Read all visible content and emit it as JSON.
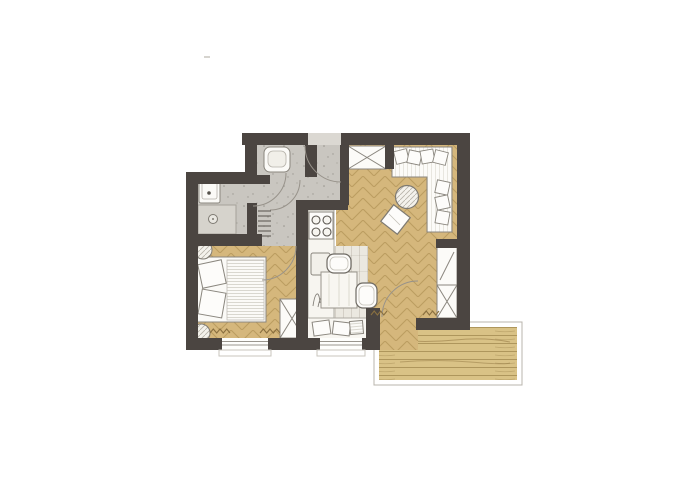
{
  "title": "apartment-floor-plan",
  "canvas": {
    "w": 700,
    "h": 500
  },
  "palette": {
    "background": "#ffffff",
    "wall": "#4b4541",
    "concrete_floor": "#c9c6c0",
    "wood_floor": "#d5b77c",
    "wood_stroke": "#927034",
    "deck_wood": "#d9c286",
    "nook_floor": "#ebe8e0",
    "furniture_fill": "#fbfaf7",
    "furniture_outline": "#8a867e",
    "door_arc": "#97928a",
    "radiator_mark": "#8a7040"
  },
  "rooms": [
    "wc-niche",
    "hallway",
    "bathroom",
    "bedroom",
    "kitchen",
    "dining-nook",
    "living-room",
    "balcony"
  ],
  "layers": [
    {
      "name": "balcony-frame",
      "kind": "rect",
      "x": 374,
      "y": 322,
      "w": 148,
      "h": 63,
      "fill": "#ffffff",
      "stroke": "#b8b4ac",
      "sw": 1
    },
    {
      "name": "balcony-deck",
      "kind": "rect",
      "x": 379,
      "y": 327,
      "w": 138,
      "h": 53,
      "fill": "url(#pat-planks)"
    },
    {
      "name": "balcony-grain-1",
      "kind": "path",
      "d": "M395,340 q30,3 60,0 t55,2",
      "stroke": "rgba(130,103,50,0.45)",
      "sw": 1
    },
    {
      "name": "balcony-grain-2",
      "kind": "path",
      "d": "M400,362 q35,-3 70,0 t40,1",
      "stroke": "rgba(130,103,50,0.4)",
      "sw": 1
    },
    {
      "name": "floor-living",
      "kind": "rect",
      "x": 336,
      "y": 145,
      "w": 121,
      "h": 173,
      "fill": "url(#pat-herr)"
    },
    {
      "name": "floor-balcony-door",
      "kind": "rect",
      "x": 378,
      "y": 300,
      "w": 40,
      "h": 50,
      "fill": "url(#pat-herr)"
    },
    {
      "name": "floor-dining-nook",
      "kind": "rect",
      "x": 308,
      "y": 246,
      "w": 60,
      "h": 92,
      "fill": "url(#pat-nook)"
    },
    {
      "name": "floor-bedroom",
      "kind": "rect",
      "x": 198,
      "y": 245,
      "w": 98,
      "h": 93,
      "fill": "url(#pat-herr)"
    },
    {
      "name": "floor-hallway",
      "kind": "rect",
      "x": 257,
      "y": 145,
      "w": 84,
      "h": 65,
      "fill": "url(#pat-speckle)"
    },
    {
      "name": "floor-hallway-2",
      "kind": "rect",
      "x": 257,
      "y": 203,
      "w": 39,
      "h": 43,
      "fill": "url(#pat-speckle)"
    },
    {
      "name": "floor-bathroom",
      "kind": "rect",
      "x": 198,
      "y": 172,
      "w": 59,
      "h": 62,
      "fill": "url(#pat-speckle)"
    },
    {
      "name": "entry-threshold",
      "kind": "rect",
      "x": 308,
      "y": 133,
      "w": 33,
      "h": 12,
      "fill": "#dbd8d2"
    },
    {
      "name": "shower-tray",
      "kind": "rect",
      "x": 198,
      "y": 205,
      "w": 38,
      "h": 29,
      "fill": "#d6d3cc",
      "stroke": "#a5a19a",
      "sw": 1
    },
    {
      "name": "shower-drain",
      "kind": "circle",
      "cx": 213,
      "cy": 219,
      "r": 4.5,
      "fill": "#e9e7e1",
      "stroke": "#7e7a72",
      "sw": 1
    },
    {
      "name": "shower-drain-dot",
      "kind": "circle",
      "cx": 213,
      "cy": 219,
      "r": 1,
      "fill": "#7e7a72"
    },
    {
      "name": "washbasin",
      "kind": "rect",
      "x": 199,
      "y": 174,
      "w": 21,
      "h": 29,
      "rx": 2,
      "fill": "#fbfaf7",
      "stroke": "#8a867e",
      "sw": 1
    },
    {
      "name": "washbasin-inner",
      "kind": "rect",
      "x": 202,
      "y": 178,
      "w": 15,
      "h": 21,
      "rx": 2,
      "fill": "none",
      "stroke": "#b5b1a9",
      "sw": 0.8
    },
    {
      "name": "washbasin-tap-dot",
      "kind": "circle",
      "cx": 209,
      "cy": 193,
      "r": 1.8,
      "fill": "#56524c"
    },
    {
      "name": "toilet",
      "kind": "rect",
      "x": 264,
      "y": 147,
      "w": 26,
      "h": 25,
      "rx": 6,
      "fill": "#fbfaf7",
      "stroke": "#8a867e",
      "sw": 1
    },
    {
      "name": "toilet-bowl-inner",
      "kind": "rect",
      "x": 268,
      "y": 151,
      "w": 18,
      "h": 16,
      "rx": 5,
      "fill": "#f1efe9",
      "stroke": "#b5b1a9",
      "sw": 0.8
    },
    {
      "name": "hall-radiator",
      "kind": "ticks",
      "x": 258,
      "y": 211,
      "w": 13,
      "n": 6,
      "gap": 5,
      "stroke": "#56524c",
      "sw": 1
    },
    {
      "name": "bed-frame",
      "kind": "rect",
      "x": 196,
      "y": 257,
      "w": 70,
      "h": 65,
      "fill": "#fbfaf7",
      "stroke": "#8a867e",
      "sw": 1
    },
    {
      "name": "bed-duvet",
      "kind": "rect",
      "x": 227,
      "y": 260,
      "w": 37,
      "h": 60,
      "fill": "url(#pat-duvet)",
      "stroke": "#c2bfb7",
      "sw": 0.8
    },
    {
      "name": "bed-pillow-1",
      "kind": "rect",
      "x": 200,
      "y": 262,
      "w": 24,
      "h": 24,
      "rot": -12,
      "fill": "#fdfcfa",
      "stroke": "#8a867e",
      "sw": 1
    },
    {
      "name": "bed-pillow-2",
      "kind": "rect",
      "x": 200,
      "y": 291,
      "w": 24,
      "h": 25,
      "rot": 10,
      "fill": "#fdfcfa",
      "stroke": "#8a867e",
      "sw": 1
    },
    {
      "name": "bedroom-plant-1",
      "kind": "circle",
      "cx": 203,
      "cy": 250,
      "r": 9,
      "fill": "url(#pat-hatch)",
      "stroke": "#7e7a72",
      "sw": 1
    },
    {
      "name": "bedroom-plant-2",
      "kind": "circle",
      "cx": 201,
      "cy": 333,
      "r": 9,
      "fill": "url(#pat-hatch)",
      "stroke": "#7e7a72",
      "sw": 1
    },
    {
      "name": "bedroom-wardrobe",
      "kind": "xbox",
      "x": 280,
      "y": 299,
      "w": 24,
      "h": 39,
      "fill": "#fcfbf8",
      "stroke": "#8a867e",
      "sw": 1
    },
    {
      "name": "kitchen-counter",
      "kind": "rect",
      "x": 308,
      "y": 210,
      "w": 26,
      "h": 108,
      "fill": "#f7f5f0",
      "stroke": "#aeaaa2",
      "sw": 1
    },
    {
      "name": "stove",
      "kind": "rect",
      "x": 309,
      "y": 212,
      "w": 24,
      "h": 27,
      "fill": "#fdfcfa",
      "stroke": "#8a867e",
      "sw": 1
    },
    {
      "name": "burner-1",
      "kind": "circle",
      "cx": 316,
      "cy": 220,
      "r": 4,
      "fill": "#f7f5f0",
      "stroke": "#5b5751",
      "sw": 1.1
    },
    {
      "name": "burner-2",
      "kind": "circle",
      "cx": 327,
      "cy": 220,
      "r": 4,
      "fill": "#f7f5f0",
      "stroke": "#5b5751",
      "sw": 1.1
    },
    {
      "name": "burner-3",
      "kind": "circle",
      "cx": 316,
      "cy": 232,
      "r": 4,
      "fill": "#f7f5f0",
      "stroke": "#5b5751",
      "sw": 1.1
    },
    {
      "name": "burner-4",
      "kind": "circle",
      "cx": 327,
      "cy": 232,
      "r": 4,
      "fill": "#f7f5f0",
      "stroke": "#5b5751",
      "sw": 1.1
    },
    {
      "name": "kitchen-sink",
      "kind": "rect",
      "x": 311,
      "y": 253,
      "w": 19,
      "h": 22,
      "rx": 2,
      "fill": "#f2f0ea",
      "stroke": "#8a867e",
      "sw": 1
    },
    {
      "name": "kitchen-plant-sketch",
      "kind": "path",
      "d": "M313,306 C315,292 319,289 320,303 M318,307 C321,292 326,293 327,305 M322,306 C323,297 327,295 329,303",
      "stroke": "#85817a",
      "sw": 0.9
    },
    {
      "name": "dining-table",
      "kind": "rect",
      "x": 321,
      "y": 272,
      "w": 36,
      "h": 36,
      "fill": "#f8f6f1",
      "stroke": "#98948c",
      "sw": 1
    },
    {
      "name": "table-grain-1",
      "kind": "line",
      "x1": 329,
      "y1": 274,
      "x2": 329,
      "y2": 306,
      "stroke": "#ddd9d0",
      "sw": 1
    },
    {
      "name": "table-grain-2",
      "kind": "line",
      "x1": 339,
      "y1": 274,
      "x2": 339,
      "y2": 306,
      "stroke": "#ddd9d0",
      "sw": 1
    },
    {
      "name": "table-grain-3",
      "kind": "line",
      "x1": 349,
      "y1": 274,
      "x2": 349,
      "y2": 306,
      "stroke": "#ddd9d0",
      "sw": 1
    },
    {
      "name": "dining-chair-1",
      "kind": "rect",
      "x": 327,
      "y": 254,
      "w": 24,
      "h": 19,
      "rx": 7,
      "fill": "#fdfcfa",
      "stroke": "#6e6a63",
      "sw": 1.2
    },
    {
      "name": "dining-chair-1-inner",
      "kind": "rect",
      "x": 330,
      "y": 257,
      "w": 18,
      "h": 13,
      "rx": 5,
      "fill": "none",
      "stroke": "#c2bfb7",
      "sw": 0.8
    },
    {
      "name": "dining-chair-2",
      "kind": "rect",
      "x": 356,
      "y": 283,
      "w": 21,
      "h": 25,
      "rx": 7,
      "fill": "#fdfcfa",
      "stroke": "#6e6a63",
      "sw": 1.2
    },
    {
      "name": "dining-chair-2-inner",
      "kind": "rect",
      "x": 359,
      "y": 286,
      "w": 15,
      "h": 19,
      "rx": 5,
      "fill": "none",
      "stroke": "#c2bfb7",
      "sw": 0.8
    },
    {
      "name": "window-bench",
      "kind": "rect",
      "x": 307,
      "y": 318,
      "w": 60,
      "h": 21,
      "fill": "#f8f6f1",
      "stroke": "#aeaaa2",
      "sw": 1
    },
    {
      "name": "bench-pillow-1",
      "kind": "rect",
      "x": 313,
      "y": 321,
      "w": 17,
      "h": 14,
      "rot": -8,
      "fill": "#fdfcfa",
      "stroke": "#8a867e",
      "sw": 1
    },
    {
      "name": "bench-pillow-2",
      "kind": "rect",
      "x": 333,
      "y": 322,
      "w": 17,
      "h": 13,
      "rot": 7,
      "fill": "#fdfcfa",
      "stroke": "#8a867e",
      "sw": 1
    },
    {
      "name": "bench-pillow-3",
      "kind": "rect",
      "x": 350,
      "y": 321,
      "w": 13,
      "h": 13,
      "rot": -5,
      "fill": "url(#pat-duvet)",
      "stroke": "#8a867e",
      "sw": 1
    },
    {
      "name": "entry-wardrobe",
      "kind": "xbox",
      "x": 348,
      "y": 146,
      "w": 38,
      "h": 23,
      "fill": "#fcfbf8",
      "stroke": "#8a867e",
      "sw": 1
    },
    {
      "name": "sofa",
      "kind": "path",
      "d": "M392,147 H452 V232 H427 V177 H392 Z",
      "fill": "url(#pat-sofa)",
      "stroke": "#8a867e",
      "sw": 1
    },
    {
      "name": "sofa-pillow-1",
      "kind": "rect",
      "x": 395,
      "y": 150,
      "w": 13,
      "h": 13,
      "rot": -14,
      "fill": "#fdfcfa",
      "stroke": "#8a867e",
      "sw": 0.9
    },
    {
      "name": "sofa-pillow-2",
      "kind": "rect",
      "x": 408,
      "y": 151,
      "w": 13,
      "h": 13,
      "rot": 12,
      "fill": "#fdfcfa",
      "stroke": "#8a867e",
      "sw": 0.9
    },
    {
      "name": "sofa-pillow-3",
      "kind": "rect",
      "x": 421,
      "y": 150,
      "w": 13,
      "h": 13,
      "rot": -10,
      "fill": "#fdfcfa",
      "stroke": "#8a867e",
      "sw": 0.9
    },
    {
      "name": "sofa-pillow-4",
      "kind": "rect",
      "x": 434,
      "y": 151,
      "w": 13,
      "h": 13,
      "rot": 14,
      "fill": "#fdfcfa",
      "stroke": "#8a867e",
      "sw": 0.9
    },
    {
      "name": "sofa-pillow-5",
      "kind": "rect",
      "x": 436,
      "y": 181,
      "w": 13,
      "h": 13,
      "rot": 12,
      "fill": "#fdfcfa",
      "stroke": "#8a867e",
      "sw": 0.9
    },
    {
      "name": "sofa-pillow-6",
      "kind": "rect",
      "x": 436,
      "y": 196,
      "w": 13,
      "h": 13,
      "rot": -12,
      "fill": "#fdfcfa",
      "stroke": "#8a867e",
      "sw": 0.9
    },
    {
      "name": "sofa-pillow-7",
      "kind": "rect",
      "x": 436,
      "y": 211,
      "w": 13,
      "h": 13,
      "rot": 10,
      "fill": "#fdfcfa",
      "stroke": "#8a867e",
      "sw": 0.9
    },
    {
      "name": "coffee-table",
      "kind": "circle",
      "cx": 407,
      "cy": 197,
      "r": 11.5,
      "fill": "url(#pat-hatch)",
      "stroke": "#7e7a72",
      "sw": 1.2
    },
    {
      "name": "ottoman",
      "kind": "rect",
      "x": 385,
      "y": 209,
      "w": 21,
      "h": 21,
      "rot": 38,
      "fill": "#fdfcfa",
      "stroke": "#7e7a72",
      "sw": 1.2
    },
    {
      "name": "ottoman-line",
      "kind": "line",
      "x1": 389,
      "y1": 214,
      "x2": 400,
      "y2": 225,
      "stroke": "#c2bfb7",
      "sw": 0.8
    },
    {
      "name": "tv-sideboard",
      "kind": "rect",
      "x": 437,
      "y": 247,
      "w": 20,
      "h": 38,
      "fill": "#fcfbf8",
      "stroke": "#8a867e",
      "sw": 1
    },
    {
      "name": "tv-sideboard-diagonal",
      "kind": "line",
      "x1": 440,
      "y1": 280,
      "x2": 454,
      "y2": 252,
      "stroke": "#8a867e",
      "sw": 1
    },
    {
      "name": "living-wardrobe",
      "kind": "xbox",
      "x": 437,
      "y": 285,
      "w": 20,
      "h": 33,
      "fill": "#fcfbf8",
      "stroke": "#8a867e",
      "sw": 1
    },
    {
      "name": "wall-top-left",
      "kind": "rect",
      "x": 242,
      "y": 133,
      "w": 66,
      "h": 12,
      "fill": "#4b4541"
    },
    {
      "name": "wall-top-right",
      "kind": "rect",
      "x": 341,
      "y": 133,
      "w": 129,
      "h": 12,
      "fill": "#4b4541"
    },
    {
      "name": "wall-right",
      "kind": "rect",
      "x": 457,
      "y": 145,
      "w": 13,
      "h": 185,
      "fill": "#4b4541"
    },
    {
      "name": "wall-bottom-right",
      "kind": "rect",
      "x": 416,
      "y": 318,
      "w": 41,
      "h": 12,
      "fill": "#4b4541"
    },
    {
      "name": "wall-balcony-stub",
      "kind": "rect",
      "x": 366,
      "y": 308,
      "w": 14,
      "h": 42,
      "fill": "#4b4541"
    },
    {
      "name": "wall-bottom-a",
      "kind": "rect",
      "x": 186,
      "y": 338,
      "w": 36,
      "h": 12,
      "fill": "#4b4541"
    },
    {
      "name": "wall-bottom-b",
      "kind": "rect",
      "x": 268,
      "y": 338,
      "w": 52,
      "h": 12,
      "fill": "#4b4541"
    },
    {
      "name": "wall-bottom-c",
      "kind": "rect",
      "x": 362,
      "y": 338,
      "w": 16,
      "h": 12,
      "fill": "#4b4541"
    },
    {
      "name": "wall-left",
      "kind": "rect",
      "x": 186,
      "y": 172,
      "w": 12,
      "h": 178,
      "fill": "#4b4541"
    },
    {
      "name": "wall-step",
      "kind": "rect",
      "x": 186,
      "y": 172,
      "w": 68,
      "h": 12,
      "fill": "#4b4541"
    },
    {
      "name": "wall-wc-left",
      "kind": "rect",
      "x": 245,
      "y": 133,
      "w": 12,
      "h": 51,
      "fill": "#4b4541"
    },
    {
      "name": "wall-wc-right",
      "kind": "rect",
      "x": 305,
      "y": 145,
      "w": 12,
      "h": 32,
      "fill": "#4b4541"
    },
    {
      "name": "wall-wc-stub",
      "kind": "rect",
      "x": 245,
      "y": 175,
      "w": 25,
      "h": 9,
      "fill": "#4b4541"
    },
    {
      "name": "wall-bath-hall",
      "kind": "rect",
      "x": 247,
      "y": 203,
      "w": 10,
      "h": 43,
      "fill": "#4b4541"
    },
    {
      "name": "wall-bath-bedroom",
      "kind": "rect",
      "x": 186,
      "y": 234,
      "w": 76,
      "h": 12,
      "fill": "#4b4541"
    },
    {
      "name": "wall-kitchen-top",
      "kind": "rect",
      "x": 296,
      "y": 200,
      "w": 52,
      "h": 10,
      "fill": "#4b4541"
    },
    {
      "name": "wall-hall-living",
      "kind": "rect",
      "x": 340,
      "y": 145,
      "w": 9,
      "h": 60,
      "fill": "#4b4541"
    },
    {
      "name": "wall-kitchen",
      "kind": "rect",
      "x": 296,
      "y": 200,
      "w": 12,
      "h": 150,
      "fill": "#4b4541"
    },
    {
      "name": "wall-wardrobe-stub",
      "kind": "rect",
      "x": 385,
      "y": 145,
      "w": 9,
      "h": 24,
      "fill": "#4b4541"
    },
    {
      "name": "wall-sideboard-stub",
      "kind": "rect",
      "x": 436,
      "y": 239,
      "w": 21,
      "h": 9,
      "fill": "#4b4541"
    },
    {
      "name": "window-bedroom",
      "kind": "rect",
      "x": 222,
      "y": 338,
      "w": 46,
      "h": 12,
      "fill": "#fefefc"
    },
    {
      "name": "window-bedroom-line-1",
      "kind": "line",
      "x1": 222,
      "y1": 341.5,
      "x2": 268,
      "y2": 341.5,
      "stroke": "#9a968e",
      "sw": 1
    },
    {
      "name": "window-bedroom-line-2",
      "kind": "line",
      "x1": 222,
      "y1": 345,
      "x2": 268,
      "y2": 345,
      "stroke": "#9a968e",
      "sw": 1
    },
    {
      "name": "window-bedroom-sill",
      "kind": "rect",
      "x": 219,
      "y": 350,
      "w": 52,
      "h": 6,
      "fill": "none",
      "stroke": "#c9c6be",
      "sw": 1
    },
    {
      "name": "window-dining",
      "kind": "rect",
      "x": 320,
      "y": 338,
      "w": 42,
      "h": 12,
      "fill": "#fefefc"
    },
    {
      "name": "window-dining-line-1",
      "kind": "line",
      "x1": 320,
      "y1": 341.5,
      "x2": 362,
      "y2": 341.5,
      "stroke": "#9a968e",
      "sw": 1
    },
    {
      "name": "window-dining-line-2",
      "kind": "line",
      "x1": 320,
      "y1": 345,
      "x2": 362,
      "y2": 345,
      "stroke": "#9a968e",
      "sw": 1
    },
    {
      "name": "window-dining-sill",
      "kind": "rect",
      "x": 317,
      "y": 350,
      "w": 48,
      "h": 6,
      "fill": "none",
      "stroke": "#c9c6be",
      "sw": 1
    },
    {
      "name": "door-arc-entry",
      "kind": "path",
      "d": "M305,146 A36,36 0 0 0 341,182",
      "stroke": "#97928a",
      "sw": 1
    },
    {
      "name": "door-arc-wc",
      "kind": "path",
      "d": "M300,180 A30,30 0 0 1 270,210",
      "stroke": "#97928a",
      "sw": 1
    },
    {
      "name": "door-arc-bathroom",
      "kind": "path",
      "d": "M286,173 A33,33 0 0 1 253,206",
      "stroke": "#97928a",
      "sw": 1
    },
    {
      "name": "door-arc-bedroom",
      "kind": "path",
      "d": "M296,246 A34,34 0 0 1 262,280",
      "stroke": "#97928a",
      "sw": 1
    },
    {
      "name": "door-arc-balcony",
      "kind": "path",
      "d": "M382,317 A36,36 0 0 1 418,281",
      "stroke": "#97928a",
      "sw": 1
    },
    {
      "name": "radiator-zigzag-bedroom-1",
      "kind": "zigzag",
      "x": 210,
      "y": 329,
      "w": 20,
      "n": 6,
      "stroke": "#8a7040",
      "sw": 1.1
    },
    {
      "name": "radiator-zigzag-bedroom-2",
      "kind": "zigzag",
      "x": 260,
      "y": 329,
      "w": 20,
      "n": 6,
      "stroke": "#8a7040",
      "sw": 1.1
    },
    {
      "name": "radiator-zigzag-living-1",
      "kind": "zigzag",
      "x": 371,
      "y": 311,
      "w": 16,
      "n": 5,
      "stroke": "#8a7040",
      "sw": 1.1
    },
    {
      "name": "radiator-zigzag-living-2",
      "kind": "zigzag",
      "x": 423,
      "y": 311,
      "w": 16,
      "n": 5,
      "stroke": "#8a7040",
      "sw": 1.1
    },
    {
      "name": "print-artifact-dash",
      "kind": "line",
      "x1": 204,
      "y1": 57,
      "x2": 210,
      "y2": 57,
      "stroke": "#c8c5bf",
      "sw": 1.5
    }
  ]
}
